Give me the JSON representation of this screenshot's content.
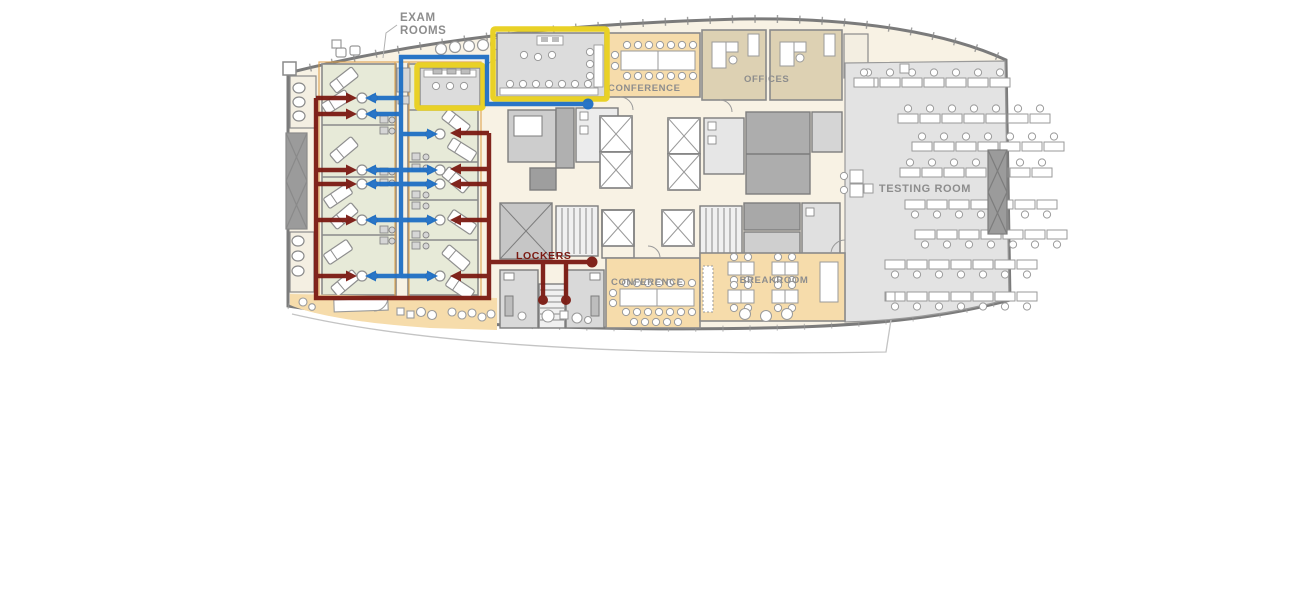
{
  "colors": {
    "annotation_red": "#7b1a12",
    "annotation_blue": "#1e6fc5",
    "highlight_yellow": "#e9d126",
    "exam_room_green": "#e7ead8",
    "tan_room": "#f6dcab",
    "office_beige": "#ddd1b3",
    "gray_room": "#e3e3e3",
    "training_room_gray": "#dcdcdc",
    "locker_room_gray": "#d9d9d9",
    "corridor_cream": "#f8f2e4",
    "wall_gray": "#7b7b7b",
    "label_gray": "#8d8d8d",
    "curtain_orange": "#dd9e45"
  },
  "labels": {
    "exam_rooms_line1": "EXAM",
    "exam_rooms_line2": "ROOMS",
    "conference_top": "CONFERENCE",
    "offices": "OFFICES",
    "testing_room": "TESTING ROOM",
    "lockers": "LOCKERS",
    "conference_bottom": "CONFERENCE",
    "breakroom": "BREAKROOM"
  }
}
